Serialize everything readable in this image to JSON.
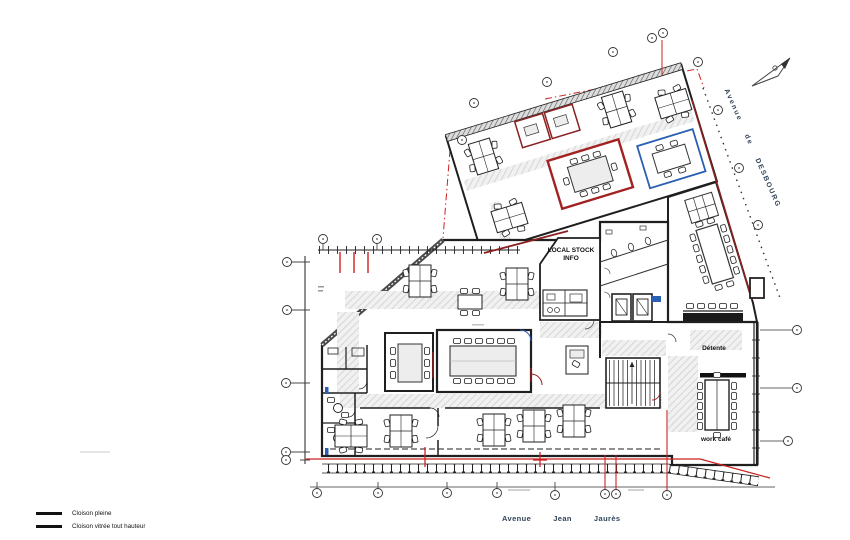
{
  "drawing": {
    "rooms": {
      "local_stock_line1": "LOCAL STOCK",
      "local_stock_line2": "INFO",
      "detente": "Détente",
      "work_cafe": "work café"
    },
    "streets": {
      "bottom_words": [
        "Avenue",
        "Jean",
        "Jaurès"
      ],
      "right_words": [
        "Avenue",
        "de",
        "DESBOURG"
      ]
    },
    "legend": {
      "items": [
        {
          "label": "Cloison pleine"
        },
        {
          "label": "Cloison vitrée tout hauteur"
        }
      ]
    },
    "colors": {
      "wall": "#1f1f1f",
      "red_partition": "#8b2020",
      "red_line": "#cc2222",
      "blue_partition": "#2b5fb3",
      "corridor_hatch": "#cfcfcf",
      "street_text": "#31445a",
      "furniture_fill": "#ededed"
    }
  }
}
